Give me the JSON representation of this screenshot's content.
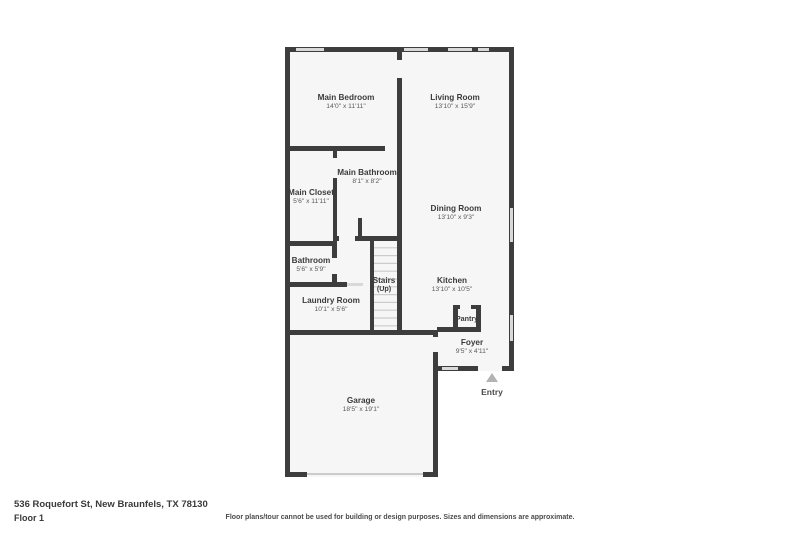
{
  "page": {
    "address": "536 Roquefort St, New Braunfels, TX 78130",
    "floor_label": "Floor 1",
    "disclaimer": "Floor plans/tour cannot be used for building or design purposes. Sizes and dimensions are approximate."
  },
  "entry": {
    "label": "Entry"
  },
  "colors": {
    "wall": "#3d3d3d",
    "room_fill": "#f6f6f6",
    "window": "#d9d9d9",
    "stair_tread": "#cccccc",
    "entry_arrow": "#b3b3b3",
    "room_name_text": "#3b3b3b",
    "room_dim_text": "#5a5a5a"
  },
  "rooms": [
    {
      "id": "main-bedroom",
      "name": "Main Bedroom",
      "sub": "14'0\" x 11'11\"",
      "x": 346,
      "y": 100
    },
    {
      "id": "living-room",
      "name": "Living Room",
      "sub": "13'10\" x 15'9\"",
      "x": 455,
      "y": 100
    },
    {
      "id": "main-bathroom",
      "name": "Main Bathroom",
      "sub": "8'1\" x 8'2\"",
      "x": 367,
      "y": 175
    },
    {
      "id": "main-closet",
      "name": "Main Closet",
      "sub": "5'6\" x 11'11\"",
      "x": 311,
      "y": 195
    },
    {
      "id": "dining-room",
      "name": "Dining Room",
      "sub": "13'10\" x 9'3\"",
      "x": 456,
      "y": 211
    },
    {
      "id": "bathroom",
      "name": "Bathroom",
      "sub": "5'6\" x 5'9\"",
      "x": 311,
      "y": 263
    },
    {
      "id": "stairs",
      "name": "Stairs",
      "sub": "(Up)",
      "x": 384,
      "y": 283,
      "sub_bold": true
    },
    {
      "id": "kitchen",
      "name": "Kitchen",
      "sub": "13'10\" x 10'5\"",
      "x": 452,
      "y": 283
    },
    {
      "id": "laundry-room",
      "name": "Laundry Room",
      "sub": "10'1\" x 5'6\"",
      "x": 331,
      "y": 303
    },
    {
      "id": "pantry",
      "name": "Pantry",
      "sub": "",
      "x": 467,
      "y": 321,
      "small": true
    },
    {
      "id": "foyer",
      "name": "Foyer",
      "sub": "9'5\" x 4'11\"",
      "x": 472,
      "y": 345
    },
    {
      "id": "garage",
      "name": "Garage",
      "sub": "18'5\" x 19'1\"",
      "x": 361,
      "y": 403
    }
  ]
}
